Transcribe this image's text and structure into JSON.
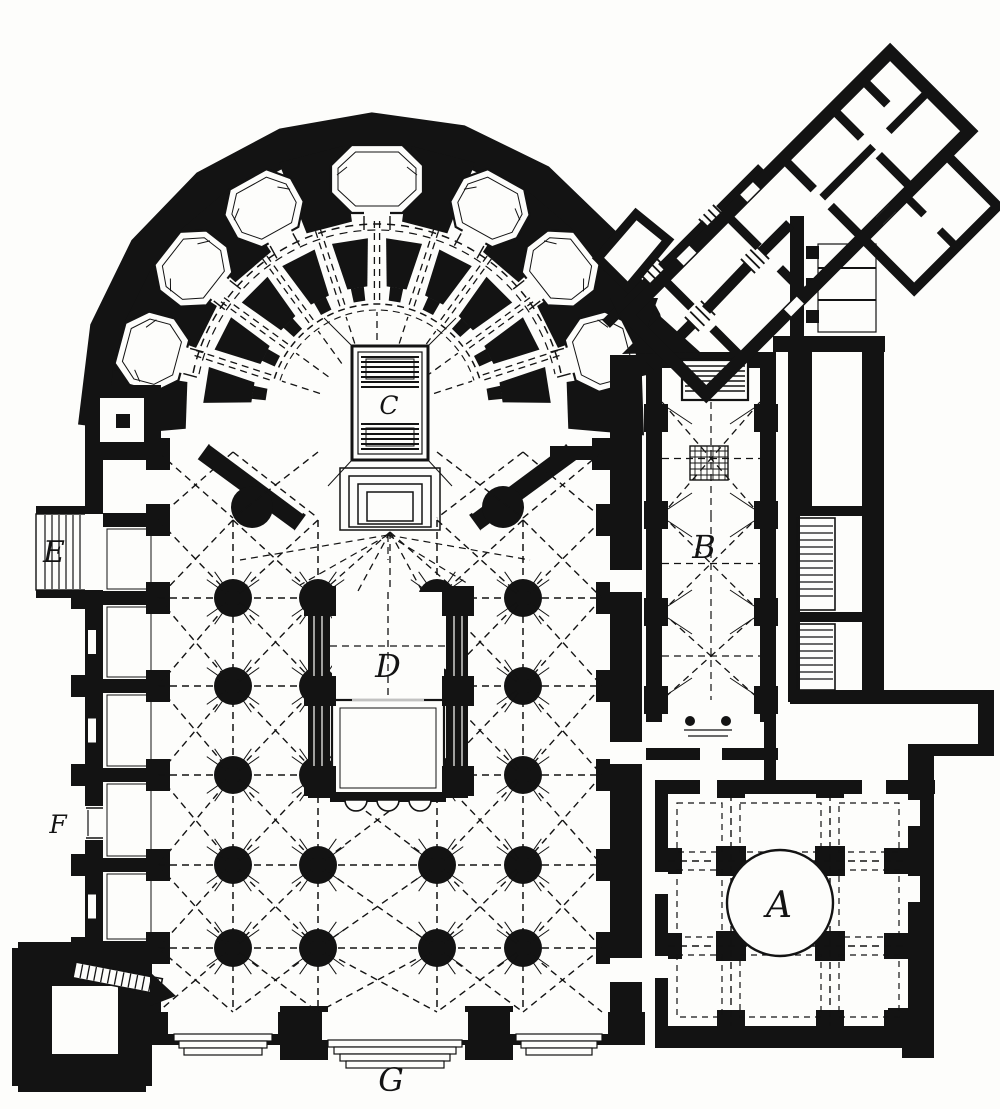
{
  "figure": {
    "kind": "architectural-floor-plan",
    "description": "Black ink engraved ground plan of a cathedral: semicircular rotunda chevet with radiating chapels (C), choir enclosure (D) in a five-aisle nave, royal chapel (B), domed square hall (A), stair E, door F, west portal G, corner bell tower and a diagonal annex wing."
  },
  "colors": {
    "ink": "#131313",
    "paper": "#fdfdfb"
  },
  "labels": [
    {
      "id": "a",
      "text": "A",
      "x": 779,
      "y": 917,
      "size": 36
    },
    {
      "id": "b",
      "text": "B",
      "x": 704,
      "y": 558,
      "size": 32
    },
    {
      "id": "c",
      "text": "C",
      "x": 389,
      "y": 414,
      "size": 25
    },
    {
      "id": "d",
      "text": "D",
      "x": 388,
      "y": 677,
      "size": 32
    },
    {
      "id": "e",
      "text": "E",
      "x": 54,
      "y": 562,
      "size": 30
    },
    {
      "id": "f",
      "text": "F",
      "x": 58,
      "y": 833,
      "size": 25
    },
    {
      "id": "g",
      "text": "G",
      "x": 391,
      "y": 1091,
      "size": 32
    }
  ]
}
